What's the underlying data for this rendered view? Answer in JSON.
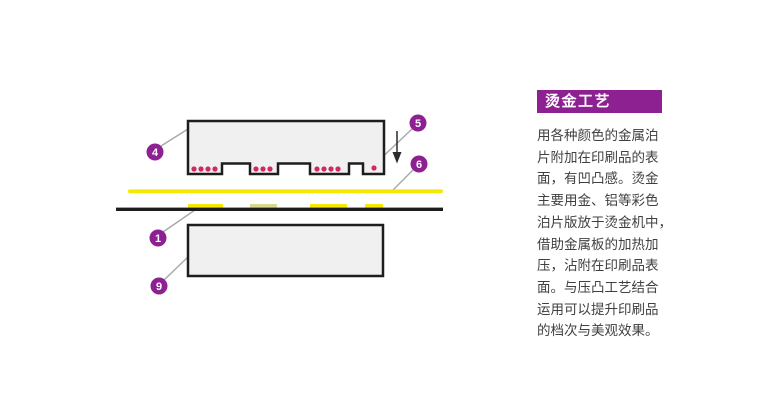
{
  "panel": {
    "title": "烫金工艺",
    "accent_color": "#8d2192",
    "text_color": "#404040",
    "lines": [
      "用各种颜色的金属泊",
      "片附加在印刷品的表",
      "面，有凹凸感。烫金",
      "主要用金、铝等彩色",
      "泊片版放于烫金机中，",
      "借助金属板的加热加",
      "压，沾附在印刷品表",
      "面。与压凸工艺结合",
      "运用可以提升印刷品",
      "的档次与美观效果。"
    ]
  },
  "diagram": {
    "colors": {
      "plate_fill": "#f0f0f0",
      "plate_stroke": "#1d1d1d",
      "foil_yellow": "#f6e800",
      "foil_pale": "#d9d98e",
      "substrate_black": "#1c1c1c",
      "dot_red": "#d22a5e",
      "callout_fill": "#8d2192",
      "callout_text": "#ffffff",
      "leader_gray": "#a8a8a8",
      "arrow_color": "#2b2b2b"
    },
    "upper_plate": {
      "points": "188,121 384,121 384,174 363,174 363,163.5 349,163.5 349,174 310,174 310,163.5 278,163.5 278,174 250,174 250,163.5 222,163.5 222,174 188,174"
    },
    "heat_dots": [
      [
        194,
        169
      ],
      [
        201,
        169
      ],
      [
        208,
        169
      ],
      [
        215,
        169
      ],
      [
        256,
        169
      ],
      [
        263,
        169
      ],
      [
        270,
        169
      ],
      [
        317,
        169
      ],
      [
        324,
        169
      ],
      [
        331,
        169
      ],
      [
        338,
        169
      ],
      [
        374,
        168
      ]
    ],
    "foil_line": {
      "x": 128,
      "y": 189.4,
      "w": 315,
      "h": 3.8
    },
    "substrate_line": {
      "x": 116,
      "y": 207.6,
      "w": 327,
      "h": 3.4
    },
    "foil_patches": [
      {
        "x": 188,
        "w": 35,
        "pale": false
      },
      {
        "x": 250,
        "w": 27,
        "pale": true
      },
      {
        "x": 310,
        "w": 37,
        "pale": false
      },
      {
        "x": 365,
        "w": 18,
        "pale": false
      }
    ],
    "lower_plate": {
      "x": 188,
      "y": 225,
      "w": 195,
      "h": 51
    },
    "callouts": [
      {
        "num": "4",
        "cx": 155,
        "cy": 152,
        "lx1": 161,
        "ly1": 146,
        "lx2": 188,
        "ly2": 129
      },
      {
        "num": "5",
        "cx": 418,
        "cy": 123,
        "lx1": 412,
        "ly1": 129,
        "lx2": 374,
        "ly2": 165
      },
      {
        "num": "6",
        "cx": 419,
        "cy": 164,
        "lx1": 413,
        "ly1": 170,
        "lx2": 393,
        "ly2": 190
      },
      {
        "num": "1",
        "cx": 158,
        "cy": 238,
        "lx1": 163,
        "ly1": 232,
        "lx2": 195,
        "ly2": 210
      },
      {
        "num": "9",
        "cx": 159,
        "cy": 286,
        "lx1": 164,
        "ly1": 280,
        "lx2": 188,
        "ly2": 257
      }
    ],
    "press_arrow": {
      "x": 397,
      "y1": 131,
      "y2": 153,
      "head_y": 163.5,
      "head_half_w": 4.5
    }
  }
}
